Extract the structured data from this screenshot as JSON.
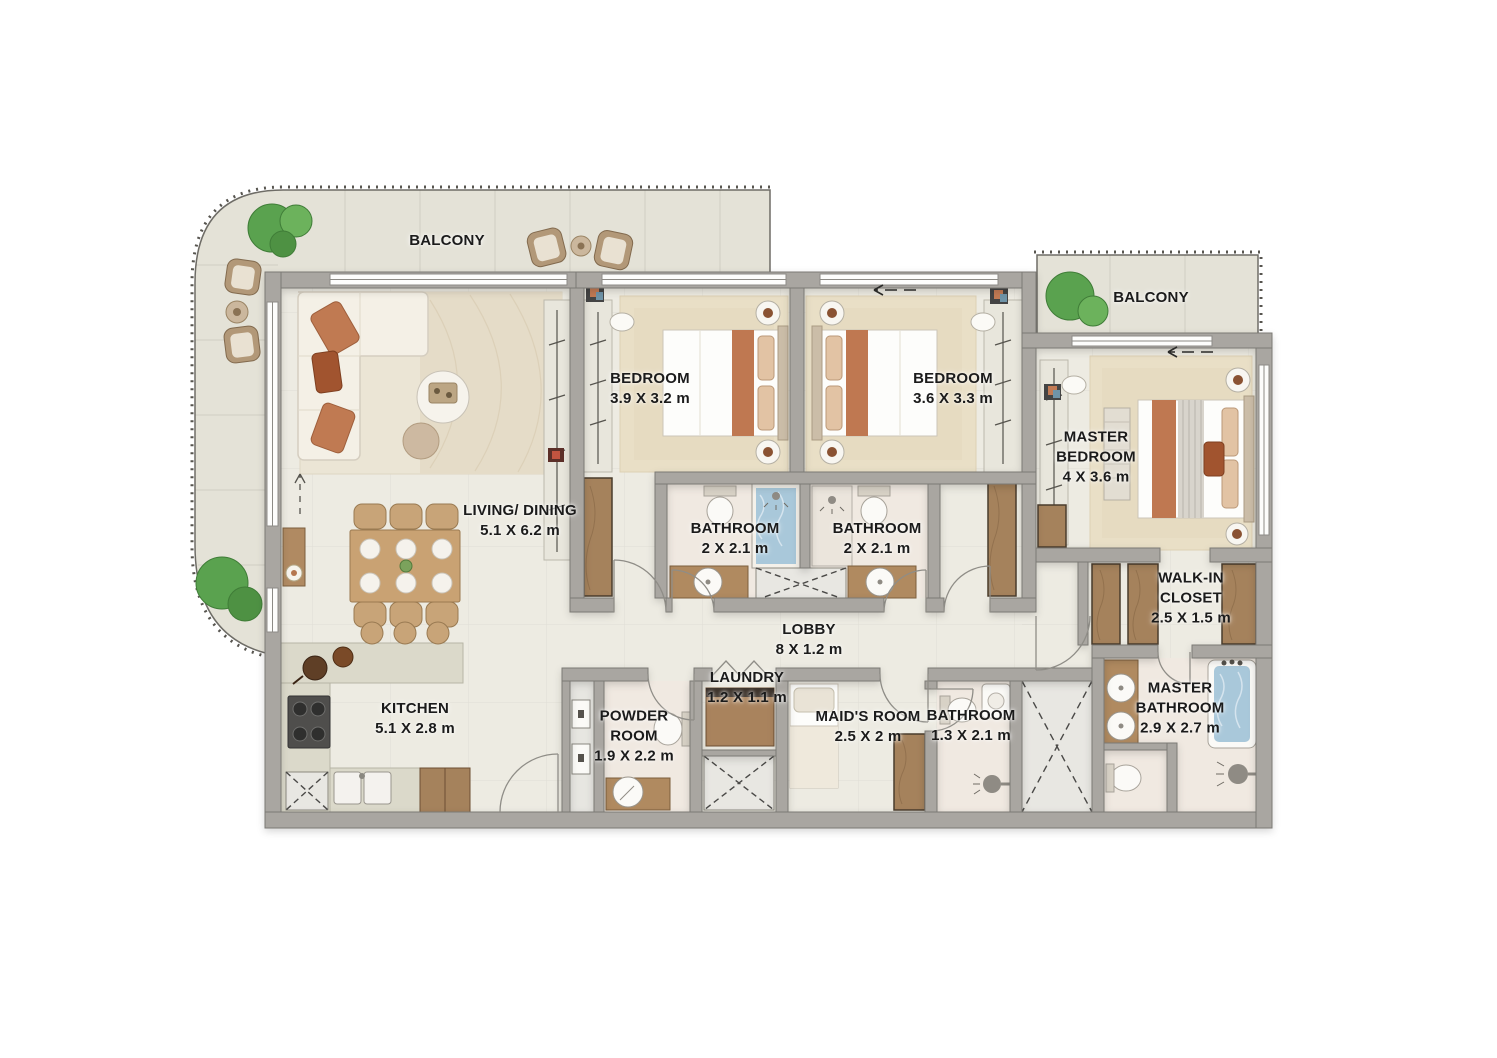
{
  "plan": {
    "rooms": {
      "balcony_left": {
        "label": "BALCONY"
      },
      "balcony_right": {
        "label": "BALCONY"
      },
      "living_dining": {
        "label": "LIVING/ DINING",
        "dims": "5.1 X 6.2 m"
      },
      "bedroom_1": {
        "label": "BEDROOM",
        "dims": "3.9 X 3.2 m"
      },
      "bedroom_2": {
        "label": "BEDROOM",
        "dims": "3.6 X 3.3 m"
      },
      "master_bedroom": {
        "label": "MASTER BEDROOM",
        "dims": "4 X 3.6 m"
      },
      "bathroom_1": {
        "label": "BATHROOM",
        "dims": "2 X 2.1 m"
      },
      "bathroom_2": {
        "label": "BATHROOM",
        "dims": "2 X 2.1 m"
      },
      "walk_in_closet": {
        "label": "WALK-IN CLOSET",
        "dims": "2.5 X 1.5 m"
      },
      "master_bathroom": {
        "label": "MASTER BATHROOM",
        "dims": "2.9 X 2.7 m"
      },
      "lobby": {
        "label": "LOBBY",
        "dims": "8 X 1.2 m"
      },
      "laundry": {
        "label": "LAUNDRY",
        "dims": "1.2 X 1.1 m"
      },
      "powder_room": {
        "label": "POWDER ROOM",
        "dims": "1.9 X 2.2 m"
      },
      "maids_room": {
        "label": "MAID'S ROOM",
        "dims": "2.5 X 2 m"
      },
      "bathroom_3": {
        "label": "BATHROOM",
        "dims": "1.3 X 2.1 m"
      },
      "kitchen": {
        "label": "KITCHEN",
        "dims": "5.1 X 2.8 m"
      }
    },
    "colors": {
      "wall": "#a9a6a1",
      "floor": "#edebe2",
      "balcony_floor": "#e4e2d7",
      "carpet": "#e9dfc6",
      "accent_terracotta": "#bf7851",
      "water_blue": "#a9c8da",
      "wood": "#a5825c",
      "plant_green": "#5aa24f",
      "label_text": "#1b1b1b"
    }
  }
}
